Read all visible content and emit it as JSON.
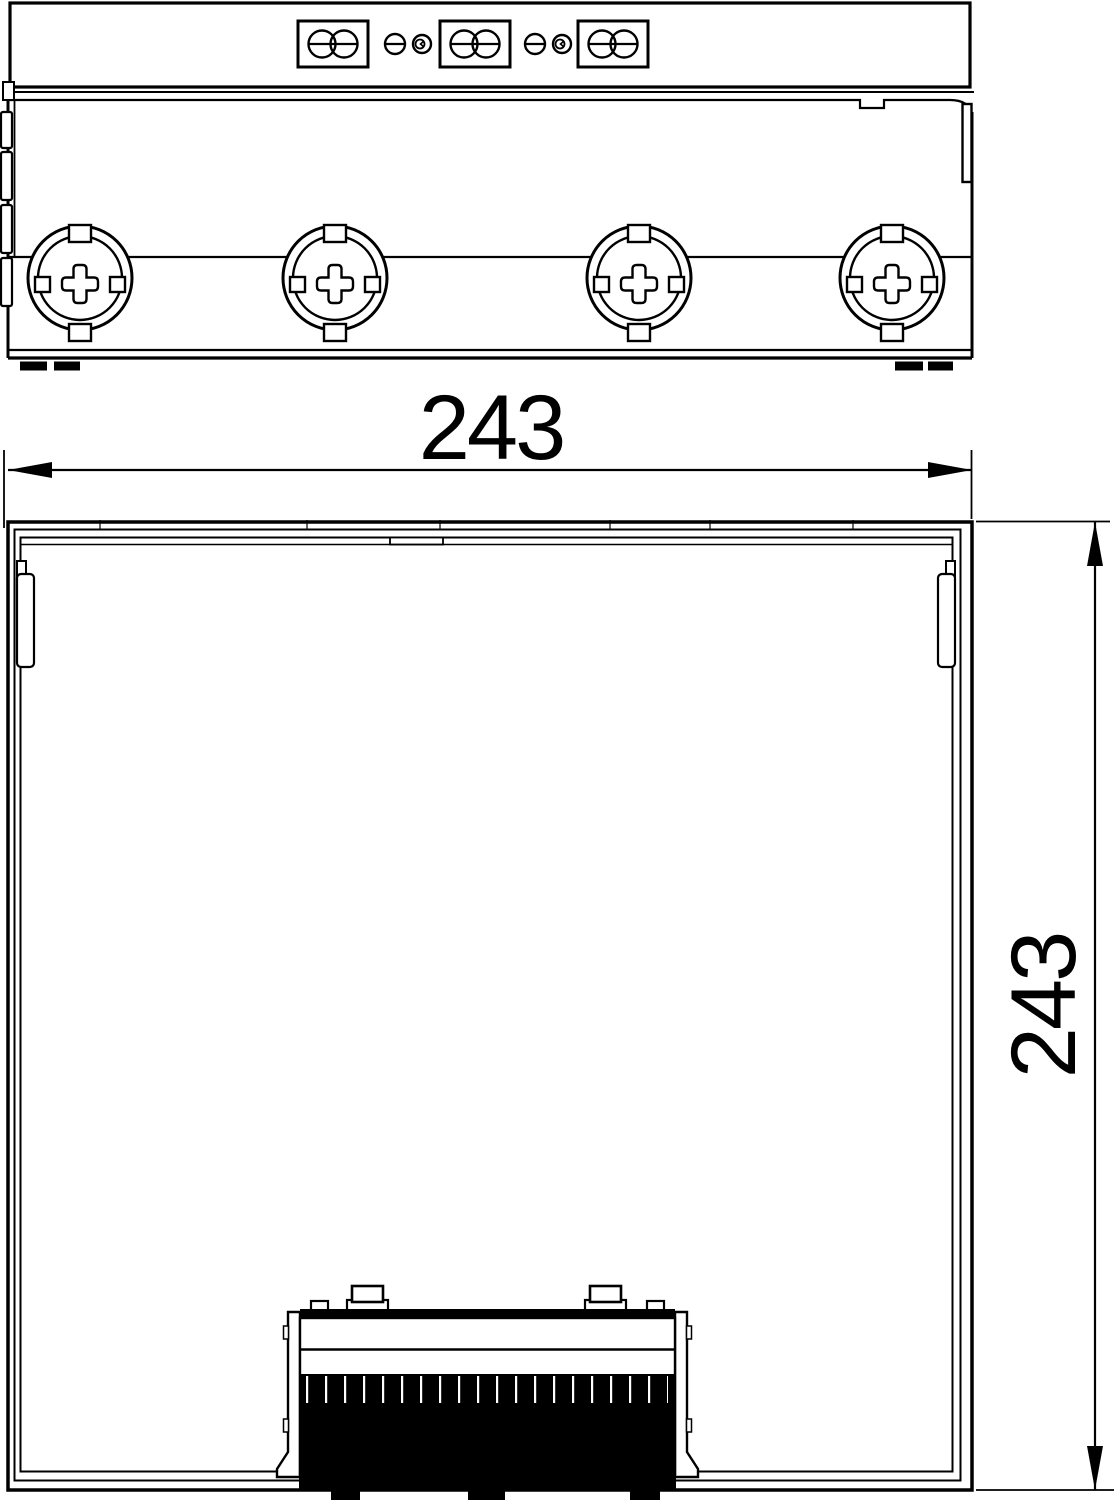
{
  "dimensions": {
    "horizontal": {
      "value": "243"
    },
    "vertical": {
      "value": "243"
    }
  },
  "colors": {
    "line": "#000000",
    "background": "#ffffff",
    "brush_fill": "#000000"
  }
}
